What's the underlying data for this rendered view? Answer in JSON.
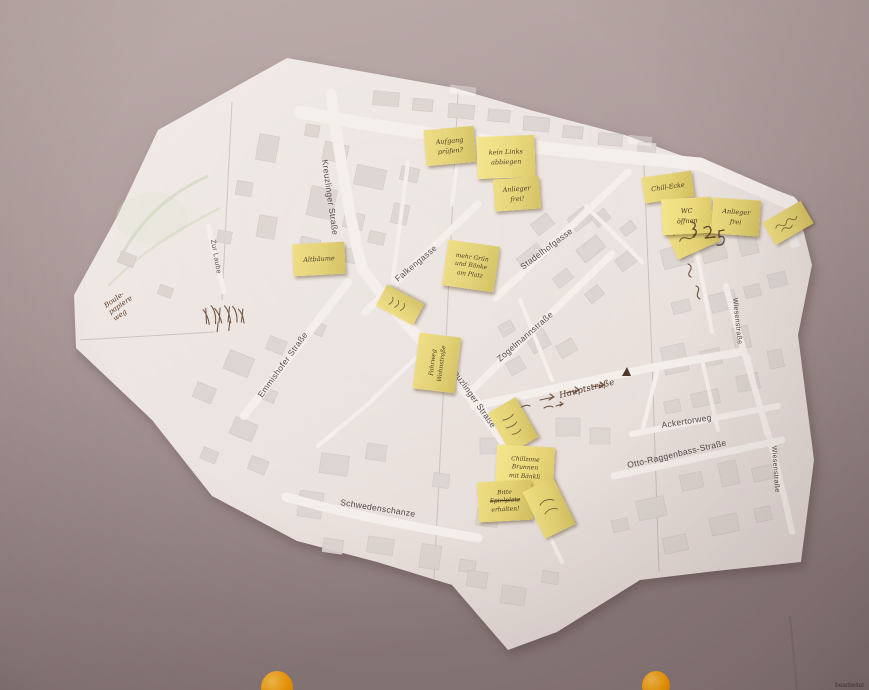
{
  "map": {
    "street_labels": [
      {
        "id": "kreuzlinger-strasse-1",
        "text": "Kreuzlinger Straße"
      },
      {
        "id": "zur-laube",
        "text": "Zur Laube"
      },
      {
        "id": "falkengasse",
        "text": "Falkengasse"
      },
      {
        "id": "stadelhofgasse",
        "text": "Stadelhofgasse"
      },
      {
        "id": "zogelmannstrasse",
        "text": "Zogelmannstraße"
      },
      {
        "id": "emmishofer-strasse",
        "text": "Emmishofer Straße"
      },
      {
        "id": "kreuzlinger-strasse-2",
        "text": "Kreuzlinger Straße"
      },
      {
        "id": "hauptstrasse",
        "text": "Hauptstraße"
      },
      {
        "id": "ackertorweg",
        "text": "Ackertorweg"
      },
      {
        "id": "otto-raggenbass-strasse",
        "text": "Otto-Raggenbass-Straße"
      },
      {
        "id": "wiesenstrasse-1",
        "text": "Wiesenstraße"
      },
      {
        "id": "wiesenstrasse-2",
        "text": "Wiesenstraße"
      },
      {
        "id": "schwedenschanze",
        "text": "Schwedenschanze"
      }
    ],
    "credit": "bearbeitet"
  },
  "map_writings": [
    {
      "medium": "pen-on-map",
      "lines": [
        "Boule-",
        "papiere",
        "weg"
      ]
    }
  ],
  "sticky_notes": [
    {
      "legible": true,
      "lines": [
        "Aufgang",
        "prüfen?"
      ]
    },
    {
      "legible": true,
      "lines": [
        "kein Links",
        "abbiegen"
      ]
    },
    {
      "legible": true,
      "lines": [
        "Anlieger",
        "frei!"
      ]
    },
    {
      "legible": true,
      "lines": [
        "Chill-Ecke"
      ]
    },
    {
      "legible": true,
      "lines": [
        "WC",
        "öffnen"
      ]
    },
    {
      "legible": false,
      "lines": []
    },
    {
      "legible": true,
      "lines": [
        "Anlieger",
        "frei"
      ]
    },
    {
      "legible": false,
      "lines": []
    },
    {
      "legible": true,
      "lines": [
        "Altbäume"
      ]
    },
    {
      "legible": true,
      "lines": [
        "mehr Grün",
        "und Bänke",
        "am Platz"
      ]
    },
    {
      "legible": false,
      "lines": []
    },
    {
      "legible": true,
      "lines": [
        "Fahrweg",
        "Wohnstraße"
      ]
    },
    {
      "legible": false,
      "lines": []
    },
    {
      "legible": true,
      "lines": [
        "Chillzone",
        "Brunnen",
        "mit Bänkli"
      ]
    },
    {
      "legible": true,
      "lines": [
        "Bitte",
        "Spielplatz",
        "erhalten!"
      ]
    },
    {
      "legible": false,
      "lines": []
    }
  ],
  "colors": {
    "wall_top": "#bcacaa",
    "wall_bottom": "#8b7a7b",
    "paper": "#ece5e1",
    "building": "#ddd4d0",
    "street": "#f5efeb",
    "sticky_note": "#e8d77a",
    "pen_ink": "#5f3b28",
    "pin_orange": "#f79d00",
    "street_label": "#544a49"
  }
}
